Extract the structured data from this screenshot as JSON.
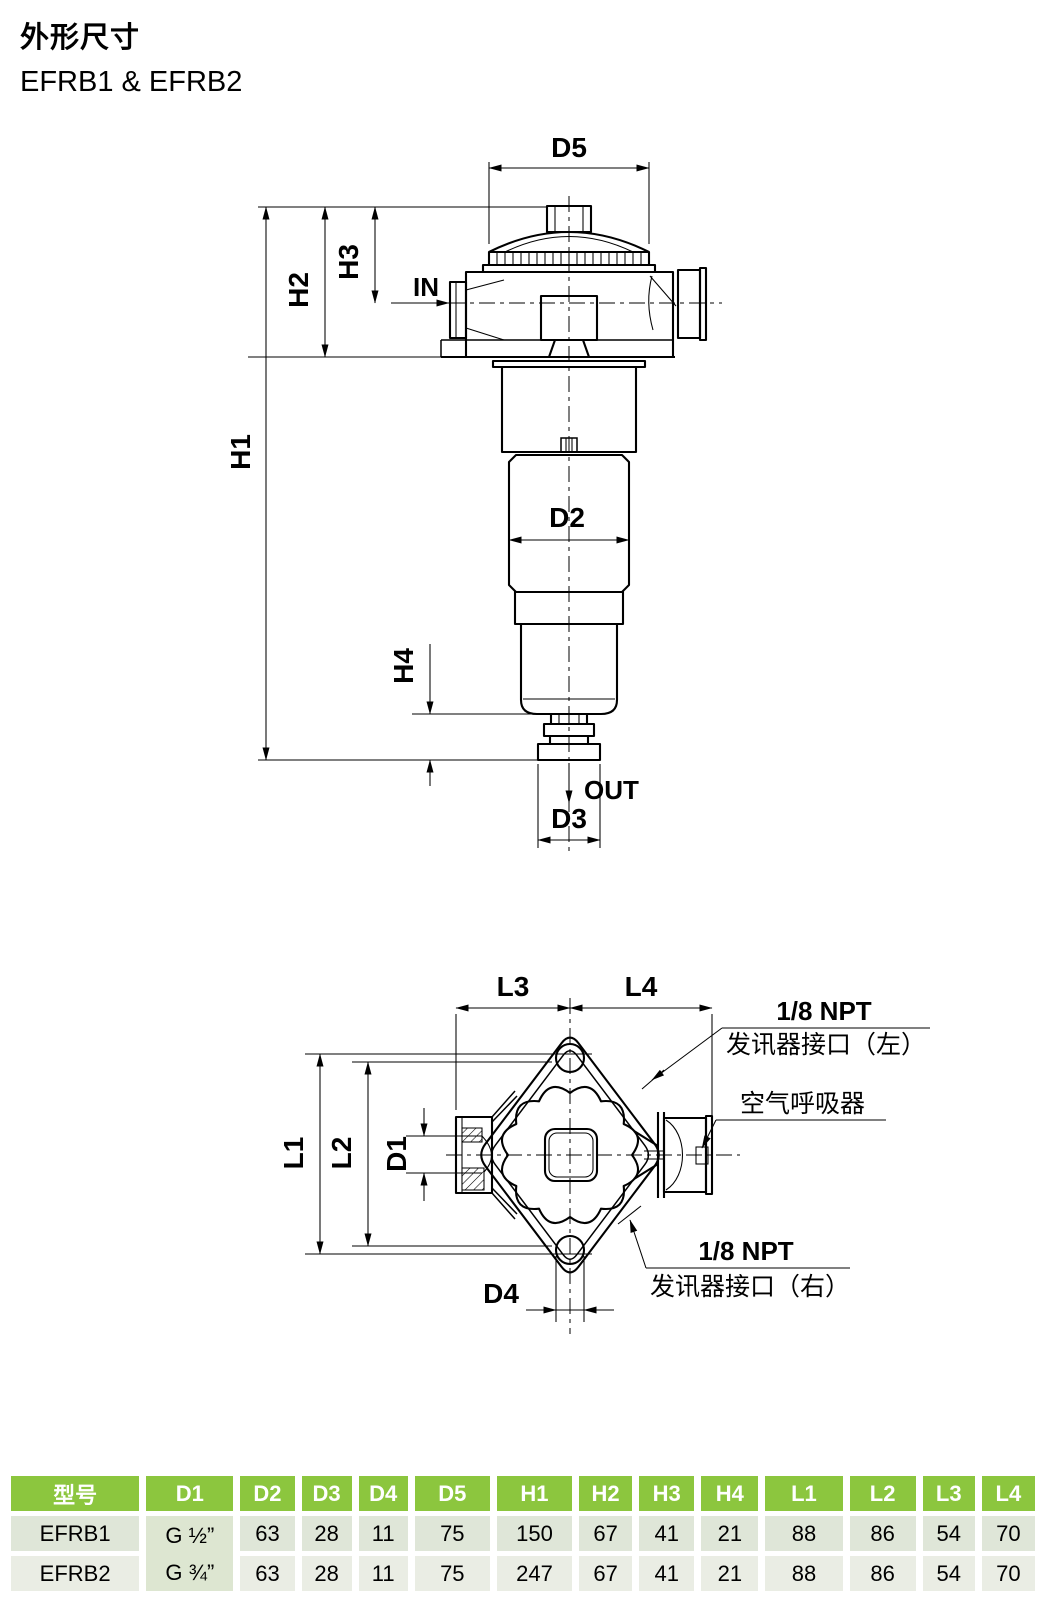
{
  "page": {
    "title": "外形尺寸",
    "subtitle": "EFRB1 & EFRB2"
  },
  "front": {
    "d5": "D5",
    "h1": "H1",
    "h2": "H2",
    "h3": "H3",
    "h4": "H4",
    "d2": "D2",
    "d3": "D3",
    "in": "IN",
    "out": "OUT"
  },
  "top": {
    "l1": "L1",
    "l2": "L2",
    "l3": "L3",
    "l4": "L4",
    "d1": "D1",
    "d4": "D4",
    "ann_left_1": "1/8 NPT",
    "ann_left_2": "发讯器接口（左）",
    "ann_breather": "空气呼吸器",
    "ann_right_1": "1/8 NPT",
    "ann_right_2": "发讯器接口（右）"
  },
  "table": {
    "headers": [
      "型号",
      "D1",
      "D2",
      "D3",
      "D4",
      "D5",
      "H1",
      "H2",
      "H3",
      "H4",
      "L1",
      "L2",
      "L3",
      "L4"
    ],
    "rows": [
      {
        "model": "EFRB1",
        "d1": "G ½”",
        "values": [
          "63",
          "28",
          "11",
          "75",
          "150",
          "67",
          "41",
          "21",
          "88",
          "86",
          "54",
          "70"
        ]
      },
      {
        "model": "EFRB2",
        "d1": "G ¾”",
        "values": [
          "63",
          "28",
          "11",
          "75",
          "247",
          "67",
          "41",
          "21",
          "88",
          "86",
          "54",
          "70"
        ]
      }
    ],
    "colors": {
      "header_bg": "#8CC63E",
      "header_text": "#FFFFFF",
      "row1_bg": "#DFE6D8",
      "row2_bg": "#EAEDE4",
      "d1_bg": "#DDE6D1"
    }
  }
}
